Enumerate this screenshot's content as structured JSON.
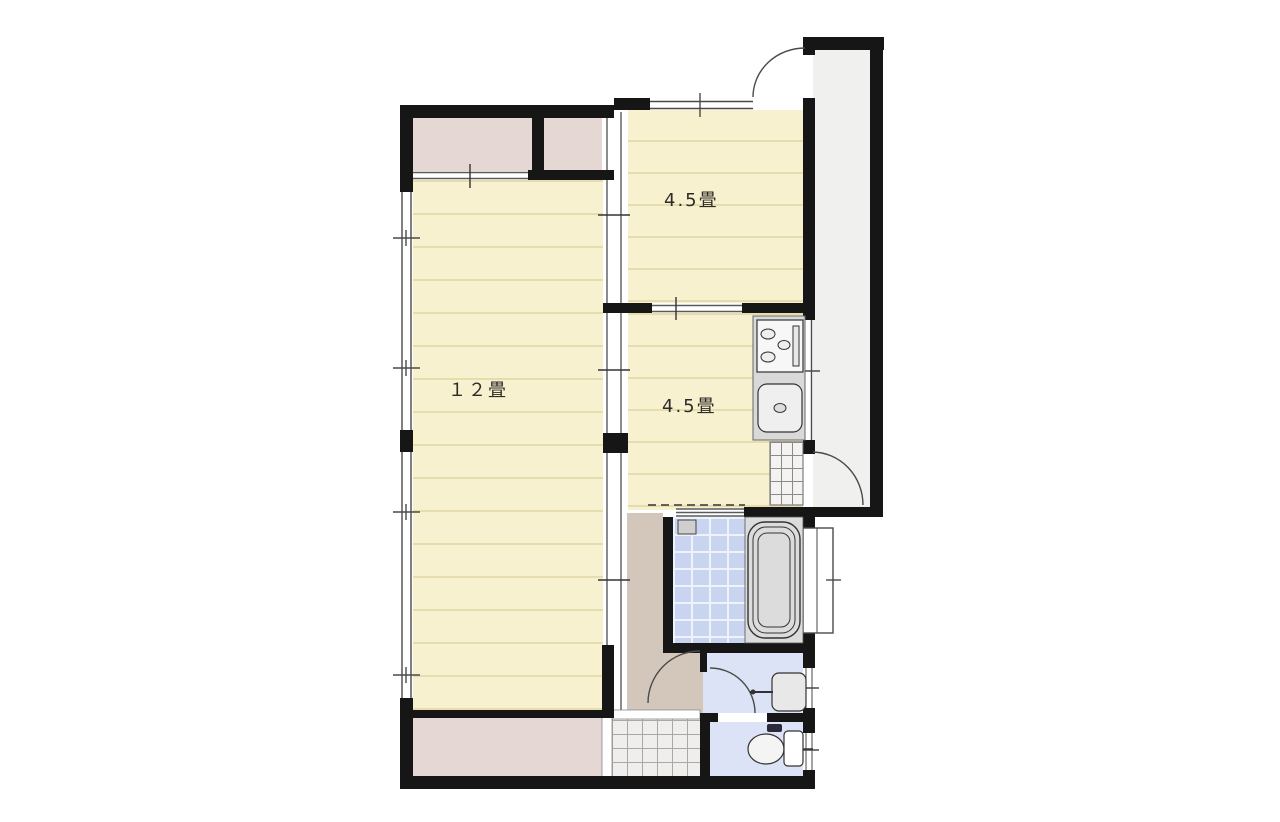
{
  "document": {
    "type": "japanese-apartment-floor-plan",
    "background": "#ffffff"
  },
  "rooms": [
    {
      "id": "living",
      "label": "１２畳",
      "floor": "tatami"
    },
    {
      "id": "bedroom",
      "label": "4.5畳",
      "floor": "tatami"
    },
    {
      "id": "kitchen",
      "label": "4.5畳",
      "floor": "tatami"
    }
  ],
  "areas": [
    "closet-upper-left",
    "closet-upper-right",
    "closet-bottom",
    "hallway",
    "bathroom",
    "washroom",
    "toilet-room",
    "entrance-tiles",
    "kitchen-door-step",
    "exterior-corridor"
  ],
  "fixtures": [
    "stove-icon",
    "kitchen-sink-icon",
    "bathtub-icon",
    "shower-box-icon",
    "washbasin-icon",
    "toilet-icon"
  ],
  "symbols": [
    "door-swing-arc",
    "sliding-door",
    "window-double-line",
    "dashed-open-boundary"
  ],
  "colors": {
    "wall": "#161616",
    "tatami": "#f8f1cf",
    "tatami_line": "#e7dcae",
    "closet": "#e5d7d3",
    "hallway": "#d3c7bb",
    "bath_tile": "#c8d4f0",
    "bath_grid": "#eef2fb",
    "sanitary": "#dde3f6",
    "counter": "#d9d9d9",
    "tub_deck": "#dcdcdc",
    "entrance_tile": "#efeeec",
    "corridor": "#f0f0ee"
  }
}
